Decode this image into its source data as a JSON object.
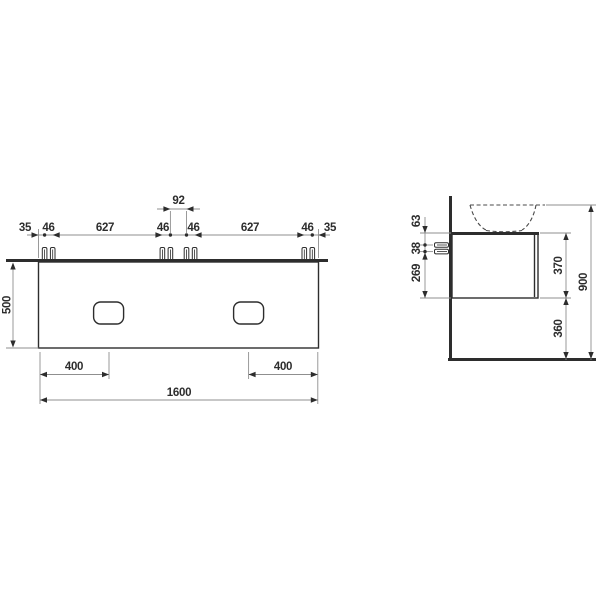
{
  "drawing": {
    "type": "technical-dimension-drawing",
    "views": [
      "front",
      "side"
    ],
    "colors": {
      "line": "#2d2d2d",
      "dim_line": "#8f8f8f",
      "background": "#ffffff"
    }
  },
  "front_view": {
    "top_dims": [
      "35",
      "46",
      "627",
      "46",
      "92",
      "46",
      "627",
      "46",
      "35"
    ],
    "height_dim": "500",
    "bottom_dims": {
      "handle_offset_left": "400",
      "handle_offset_right": "400",
      "total_width": "1600"
    }
  },
  "side_view": {
    "left_dims": [
      "63",
      "38",
      "269"
    ],
    "right_dims": {
      "cabinet_height": "370",
      "floor_clearance": "360",
      "overall_height": "900"
    }
  }
}
